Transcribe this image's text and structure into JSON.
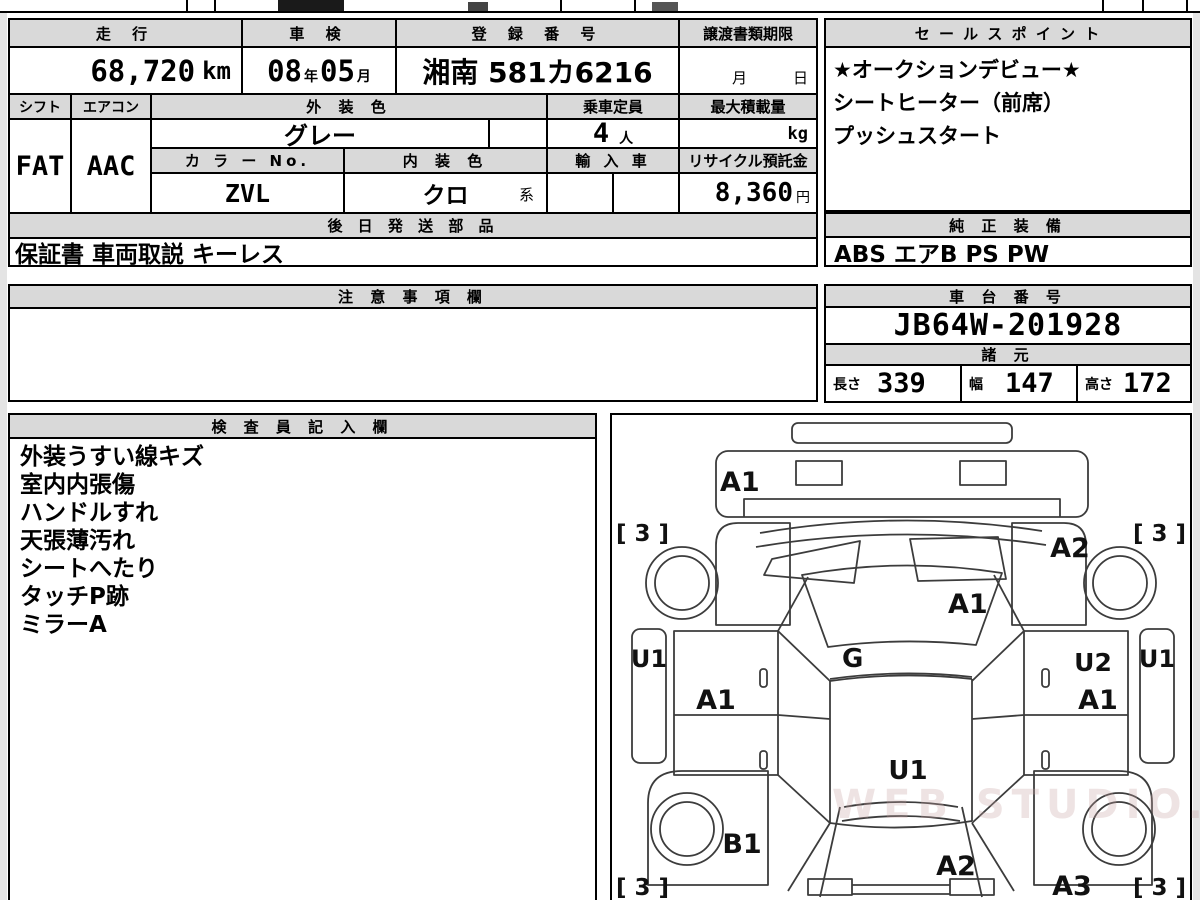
{
  "watermark": "WEB STUDIO.RU",
  "info_table": {
    "row1": {
      "h_mileage": "走 行",
      "h_inspection": "車 検",
      "h_registration": "登 録 番 号",
      "h_deadline": "譲渡書類期限",
      "mileage_value": "68,720",
      "mileage_unit": "km",
      "inspection_year": "08",
      "year_suffix": "年",
      "inspection_month": "05",
      "month_suffix": "月",
      "registration_value": "湘南 581カ6216",
      "deadline_month": "月",
      "deadline_day": "日"
    },
    "row2": {
      "h_shift": "シフト",
      "h_aircon": "エアコン",
      "h_exterior_color": "外 装 色",
      "h_capacity": "乗車定員",
      "h_max_load": "最大積載量",
      "shift_value": "FAT",
      "aircon_value": "AAC",
      "exterior_color_value": "グレー",
      "capacity_value": "4",
      "capacity_unit": "人",
      "max_load_unit": "kg"
    },
    "row3": {
      "h_color_no": "カ ラ ー No.",
      "h_interior_color": "内 装 色",
      "h_import": "輸 入 車",
      "h_recycle": "リサイクル預託金",
      "color_no_value": "ZVL",
      "interior_color_value": "クロ",
      "interior_color_suffix": "系",
      "recycle_value": "8,360",
      "recycle_unit": "円"
    },
    "row4": {
      "h_later_parts": "後 日 発 送 部 品",
      "later_parts_value": "保証書 車両取説 キーレス"
    }
  },
  "sales_point": {
    "header": "セ ー ル ス ポ イ ン ト",
    "lines": [
      "★オークションデビュー★",
      "シートヒーター（前席）",
      "プッシュスタート"
    ]
  },
  "oem_equipment": {
    "header": "純 正 装 備",
    "value": "ABS エアB PS PW"
  },
  "notes_box": {
    "header": "注 意 事 項 欄",
    "value": ""
  },
  "chassis": {
    "header": "車 台 番 号",
    "value": "JB64W-201928"
  },
  "specs": {
    "header": "諸 元",
    "length_label": "長さ",
    "length_value": "339",
    "width_label": "幅",
    "width_value": "147",
    "height_label": "高さ",
    "height_value": "172"
  },
  "inspector_box": {
    "header": "検 査 員 記 入 欄",
    "lines": [
      "外装うすい線キズ",
      "室内内張傷",
      "ハンドルすれ",
      "天張薄汚れ",
      "シートへたり",
      "タッチP跡",
      "ミラーA"
    ]
  },
  "diagram": {
    "front_bumper": "A1",
    "hood": "A1",
    "glass": "G",
    "front_left_tire": "[ 3 ]",
    "front_right_tire": "[ 3 ]",
    "front_right_fender": "A2",
    "left_rocker": "U1",
    "right_rocker": "U1",
    "left_door": "A1",
    "right_door_upper": "U2",
    "right_door": "A1",
    "roof": "U1",
    "left_quarter": "B1",
    "rear_gate": "A2",
    "right_quarter": "A3",
    "rear_left_tire": "[ 3 ]",
    "rear_right_tire": "[ 3 ]"
  }
}
